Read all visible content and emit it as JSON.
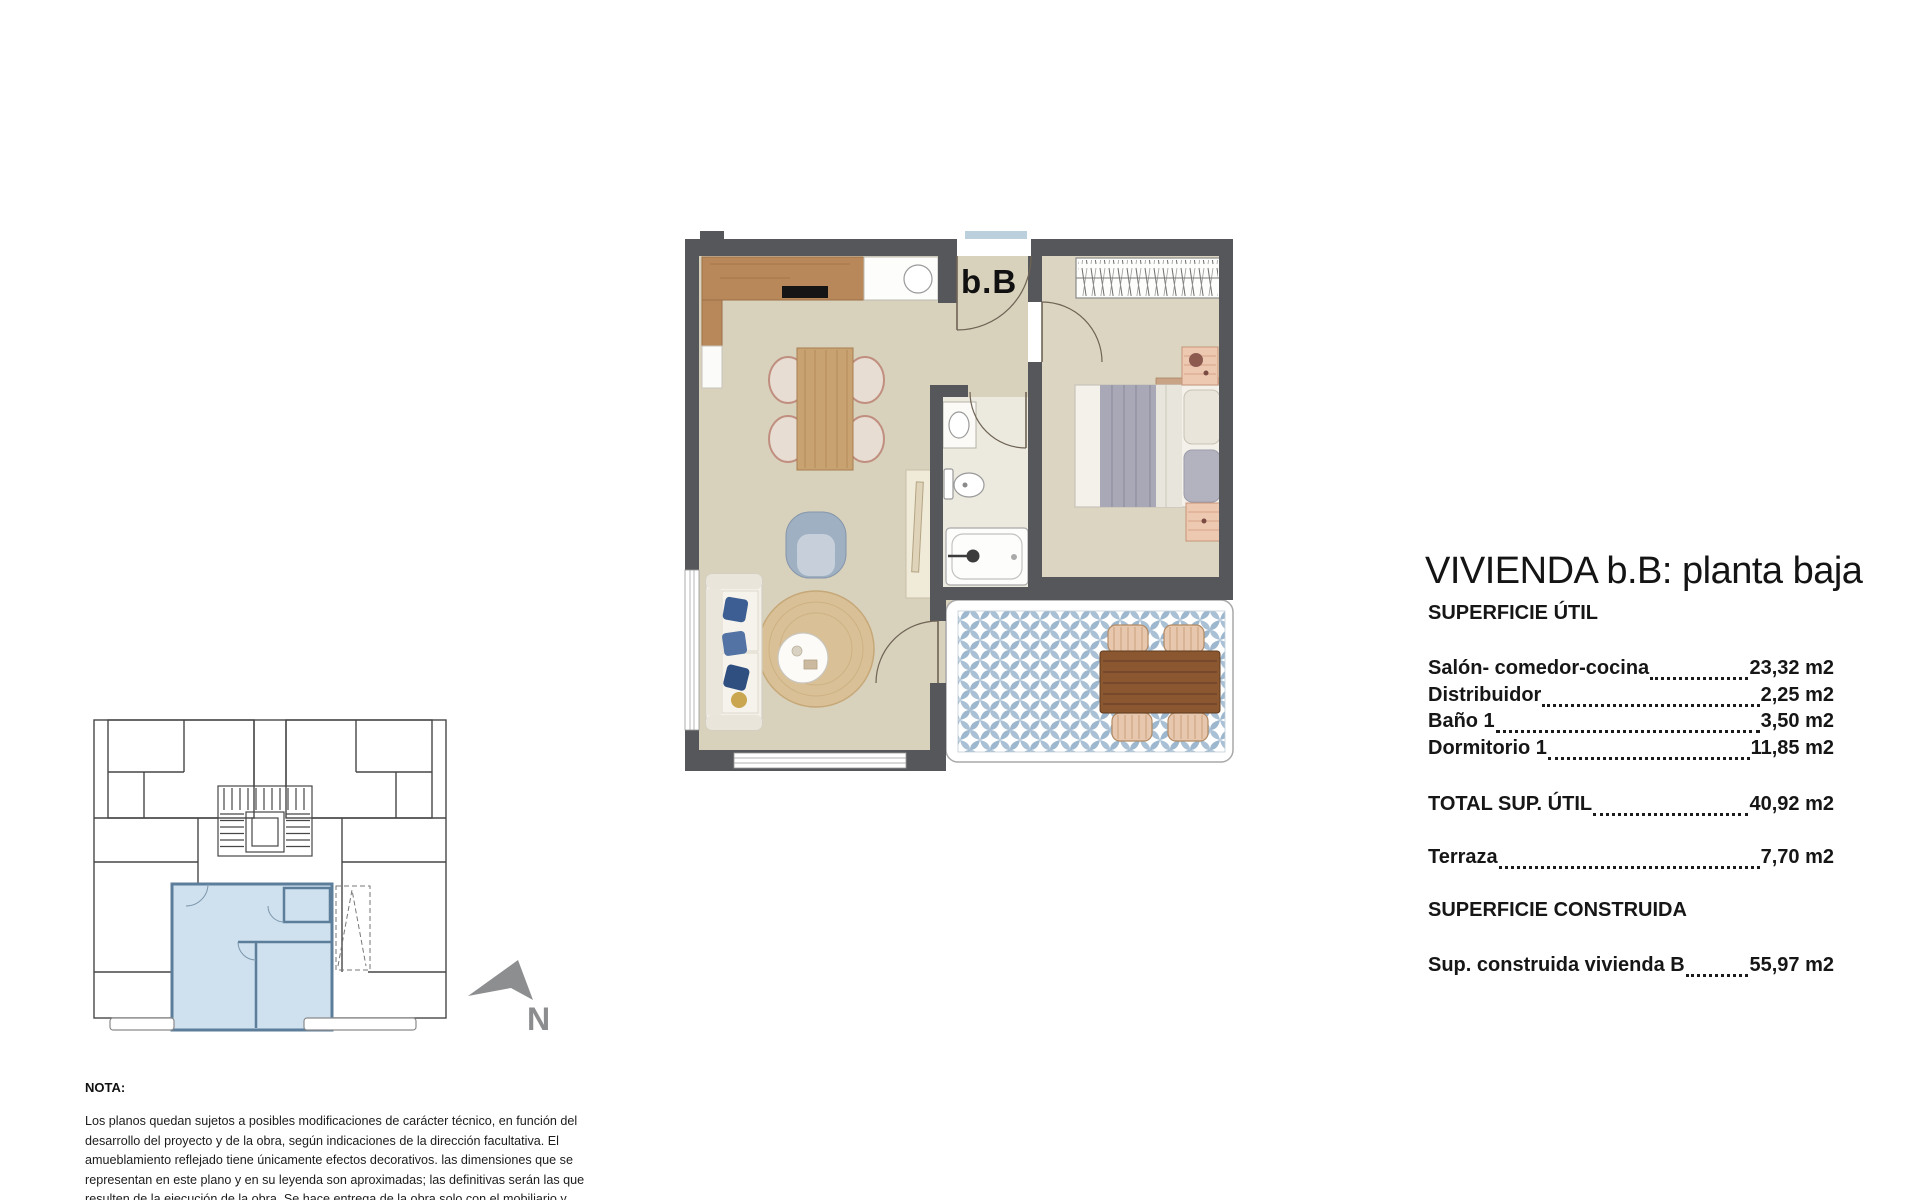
{
  "plan": {
    "unit_label": "b.B"
  },
  "north": {
    "label": "N"
  },
  "panel": {
    "title": "VIVIENDA b.B: planta baja",
    "section_util": "SUPERFICIE ÚTIL",
    "rows": [
      {
        "label": "Salón- comedor-cocina",
        "value": "23,32 m2"
      },
      {
        "label": "Distribuidor",
        "value": "2,25 m2"
      },
      {
        "label": "Baño 1",
        "value": "3,50 m2"
      },
      {
        "label": "Dormitorio 1",
        "value": "11,85 m2"
      }
    ],
    "total": {
      "label": "TOTAL SUP. ÚTIL",
      "value": "40,92 m2"
    },
    "terrace": {
      "label": "Terraza",
      "value": "7,70 m2"
    },
    "section_built": "SUPERFICIE CONSTRUIDA",
    "built": {
      "label": "Sup. construida vivienda B",
      "value": "55,97 m2"
    }
  },
  "note": {
    "heading": "NOTA:",
    "body": "Los planos quedan sujetos a posibles modificaciones de carácter técnico, en función del desarrollo del proyecto y de la obra, según indicaciones de la dirección facultativa. El amueblamiento reflejado tiene únicamente efectos decorativos. las dimensiones que se representan en este plano y en su leyenda son aproximadas; las definitivas serán las que resulten de la ejecución de la obra. Se hace entrega de la obra solo con el mobiliario y electrodomésticos que consten en la memoria de calidades. El mobiliario de la cocina y la disposición de los accesorios puede sufrir ligeras variaciones en función"
  },
  "colors": {
    "wall": "#55575a",
    "floor": "#d8d1bc",
    "bedroom_floor": "#dcd5c1",
    "kitchen_wood": "#b9885a",
    "terrace_tile_blue": "#a9c0d5",
    "key_unit_highlight": "#cfe0ee",
    "key_unit_wall": "#5d7e9a",
    "north_gray": "#8d8e90"
  }
}
